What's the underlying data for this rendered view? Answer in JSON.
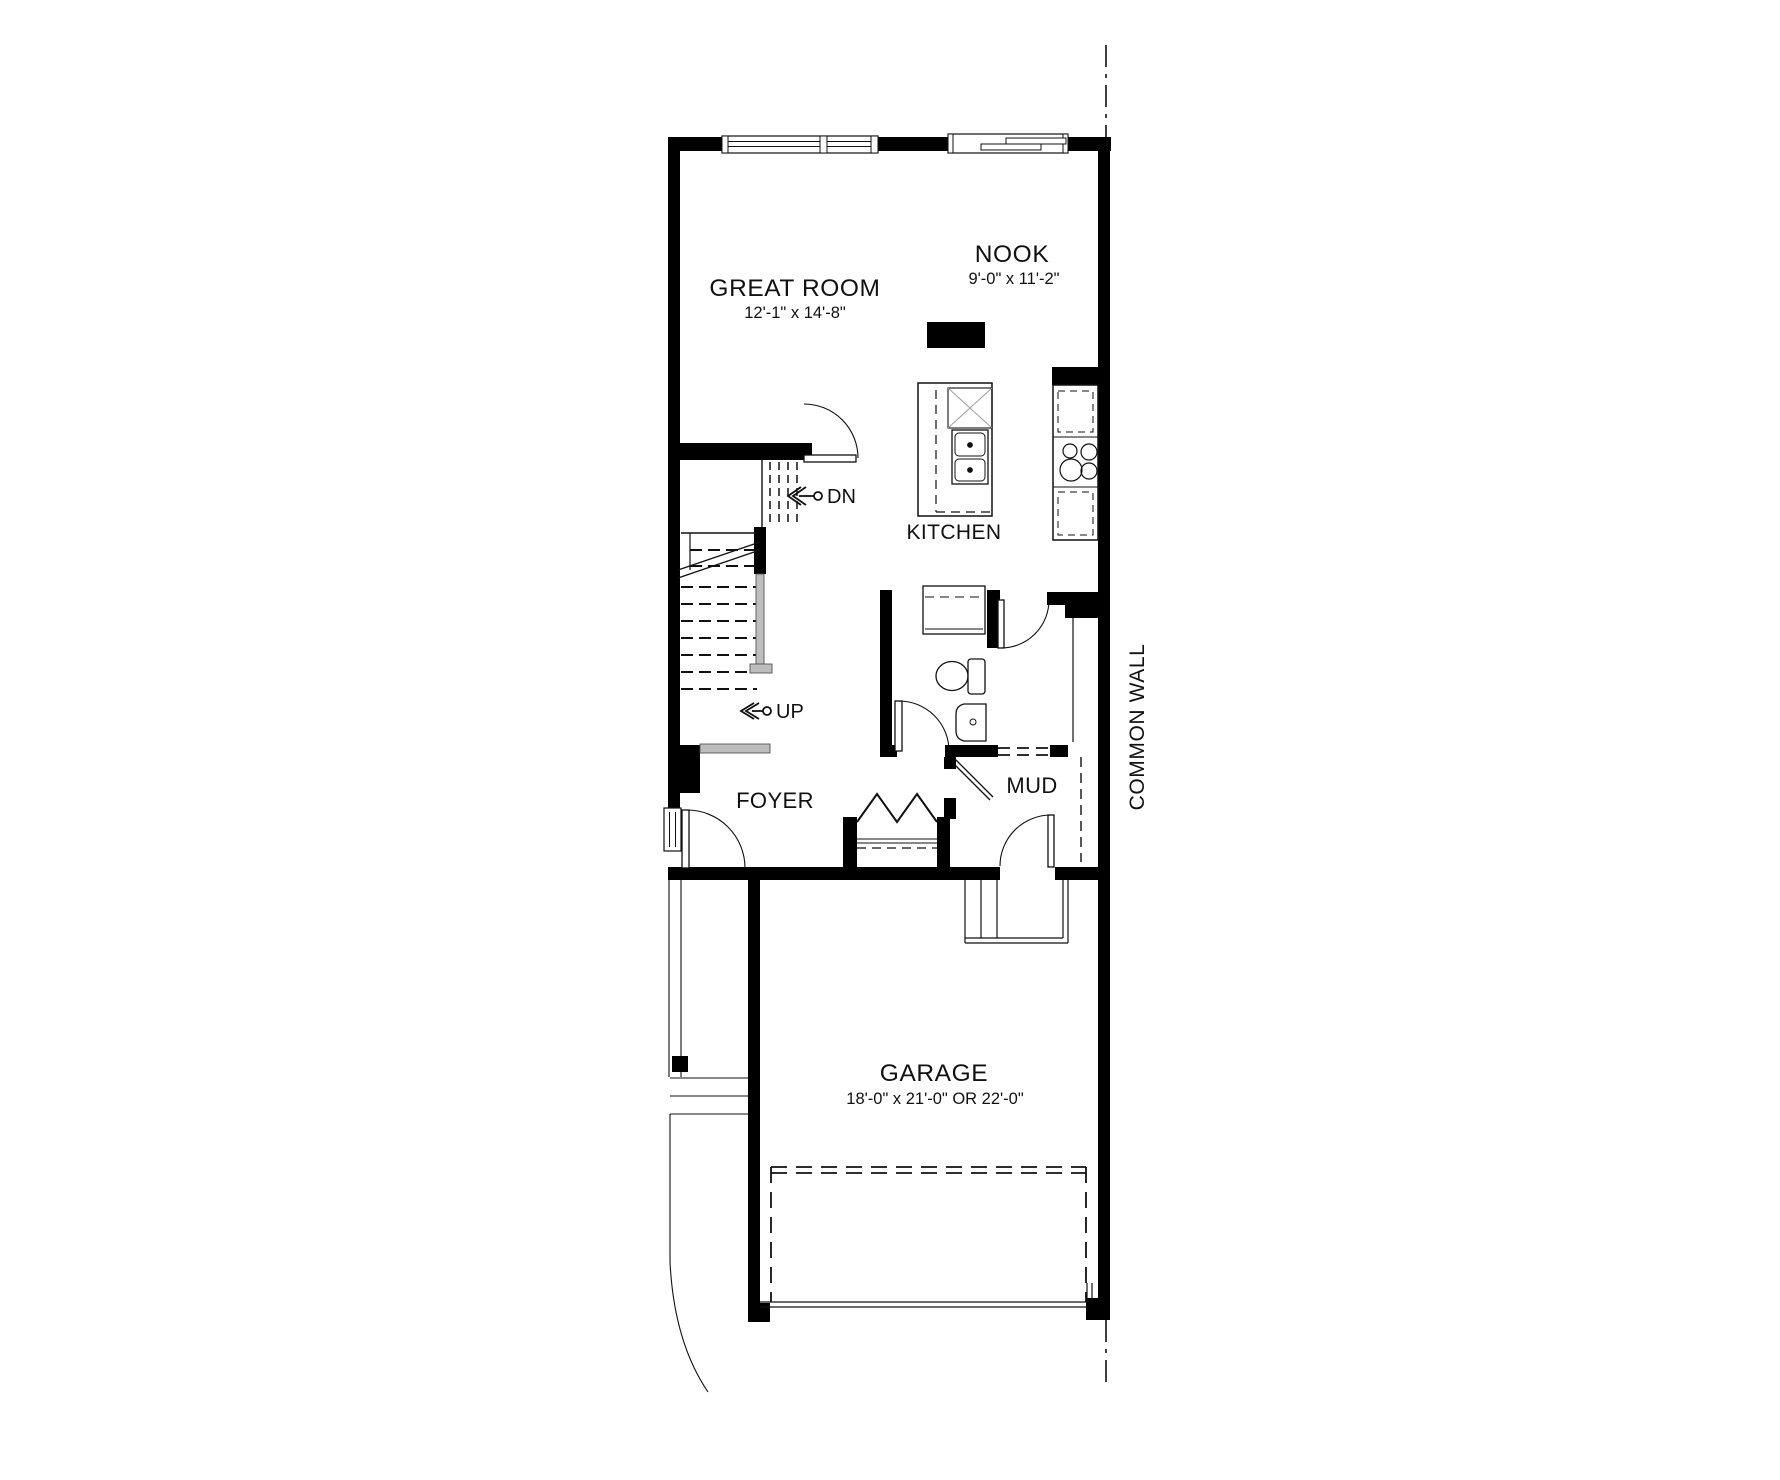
{
  "rooms": {
    "great_room": {
      "label": "GREAT ROOM",
      "dims": "12'-1\" x 14'-8\""
    },
    "nook": {
      "label": "NOOK",
      "dims": "9'-0\" x 11'-2\""
    },
    "kitchen": {
      "label": "KITCHEN"
    },
    "foyer": {
      "label": "FOYER"
    },
    "mud": {
      "label": "MUD"
    },
    "garage": {
      "label": "GARAGE",
      "dims": "18'-0\" x 21'-0\" OR 22'-0\""
    }
  },
  "stairs": {
    "up": "UP",
    "down": "DN"
  },
  "site": {
    "common_wall": "COMMON WALL"
  },
  "colors": {
    "wall": "#000000",
    "line": "#111111",
    "hatch": "#bdbdbd",
    "background": "#ffffff"
  }
}
